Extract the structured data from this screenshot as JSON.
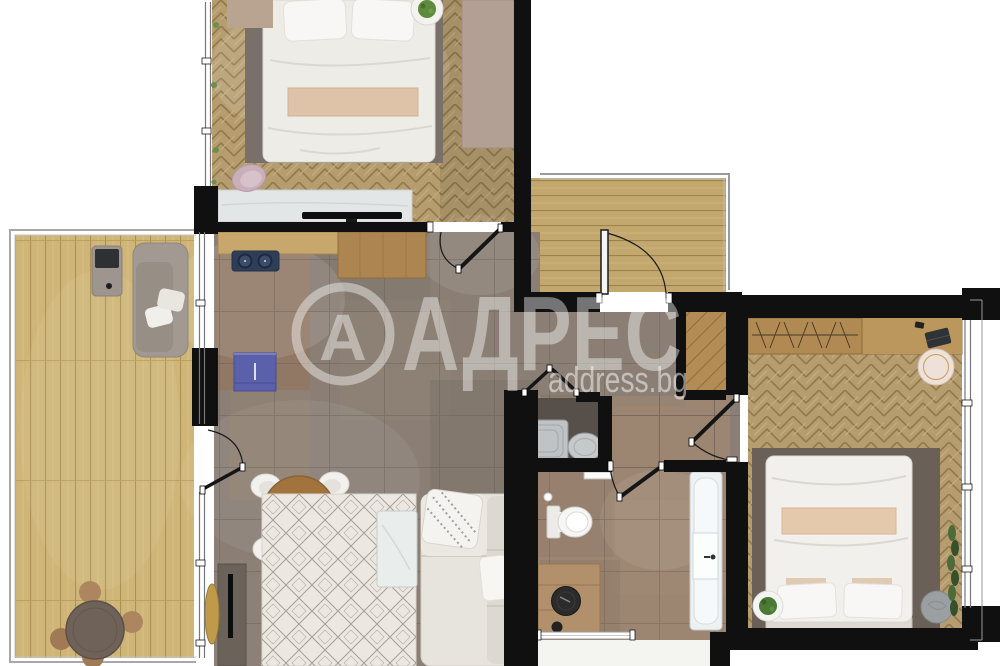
{
  "watermark": {
    "logo_letter": "А",
    "brand": "АДРЕС",
    "site": "address.bg",
    "color": "#ffffff",
    "opacity": 0.42
  },
  "palette": {
    "exterior": "#ffffff",
    "wall": "#101010",
    "herringbone_wood": "#b59d70",
    "deck_wood": "#cfb678",
    "landing_wood": "#c2a86e",
    "tile_floor": "#8b7f75",
    "bathroom_floor": "#9c8672",
    "counter_wood": "#b08a52",
    "kitchen_counter_light": "#c8a76d",
    "cooktop_navy": "#2e3e57",
    "cabinet_blue": "#5b60ab",
    "sofa_white": "#e7e4dd",
    "terrace_sofa_gray": "#a29a92",
    "rug_bedroom": "#79706a",
    "rug_living": "#ece8e1",
    "dining_table_wood": "#a1743e",
    "sink_black": "#2b2b2b",
    "fixture_white": "#f6f6f4"
  }
}
